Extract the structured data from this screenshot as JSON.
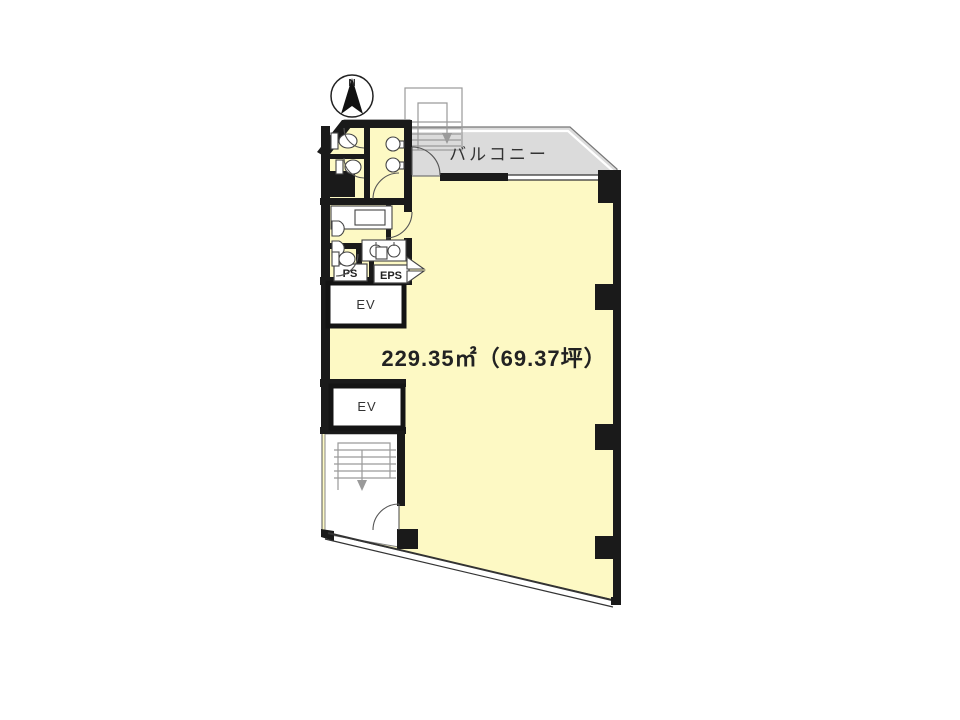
{
  "document": {
    "type": "floor-plan",
    "background": "#ffffff"
  },
  "colors": {
    "floor": "#FDF9C4",
    "balcony": "#DBDBDB",
    "wall": "#1A1A1A",
    "stair_line": "#9A9A9A",
    "outline": "#555555"
  },
  "labels": {
    "compass_north": "N",
    "balcony": "バルコニー",
    "area": "229.35㎡（69.37坪）",
    "elevator_upper": "EV",
    "elevator_lower": "EV",
    "pipe_space": "PS",
    "electrical_pipe_space": "EPS"
  }
}
